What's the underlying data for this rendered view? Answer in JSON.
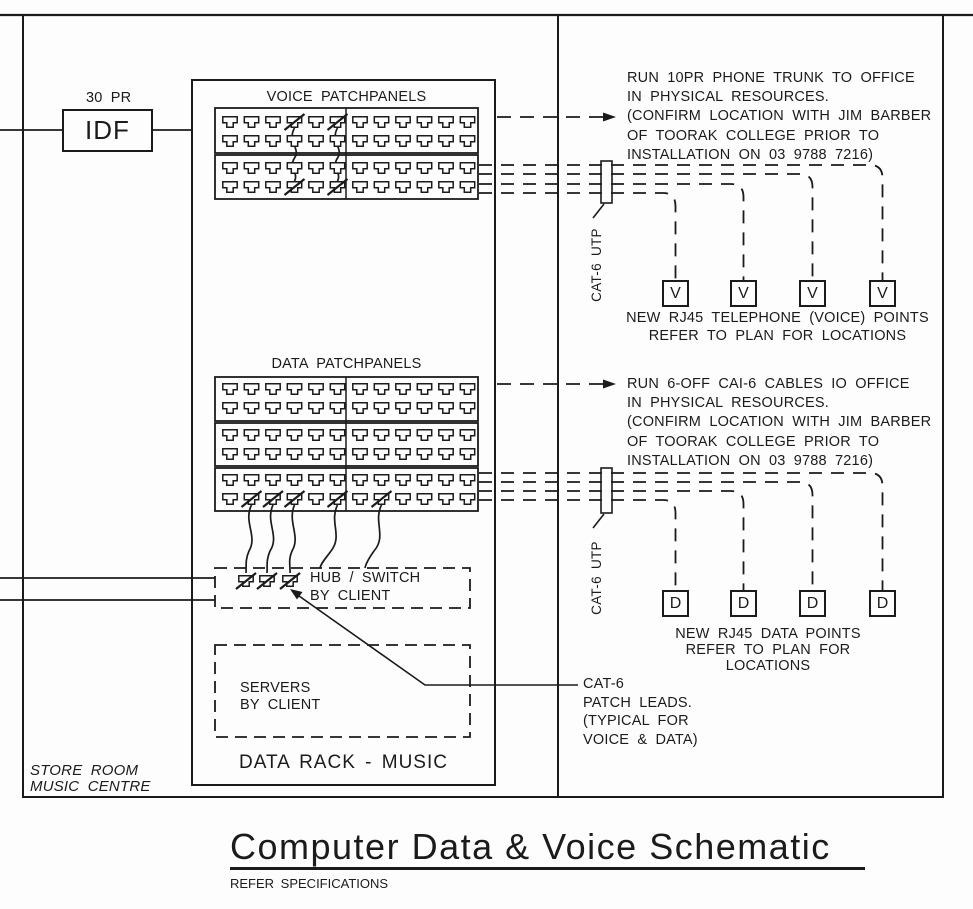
{
  "idf": {
    "label": "IDF",
    "cable": "30 PR"
  },
  "rack": {
    "title": "DATA RACK - MUSIC",
    "voice_title": "VOICE PATCHPANELS",
    "data_title": "DATA PATCHPANELS",
    "hub_line1": "HUB / SWITCH",
    "hub_line2": "BY CLIENT",
    "servers_line1": "SERVERS",
    "servers_line2": "BY CLIENT"
  },
  "room": {
    "line1": "STORE ROOM",
    "line2": "MUSIC CENTRE"
  },
  "voice_note": {
    "l1": "RUN 10PR PHONE TRUNK TO OFFICE",
    "l2": "IN PHYSICAL RESOURCES.",
    "l3": "(CONFIRM LOCATION WITH JIM BARBER",
    "l4": "OF TOORAK COLLEGE PRIOR TO",
    "l5": "INSTALLATION ON 03 9788 7216)"
  },
  "data_note": {
    "l1": "RUN 6-OFF CAI-6 CABLES IO OFFICE",
    "l2": "IN PHYSICAL RESOURCES.",
    "l3": "(CONFIRM LOCATION WITH JIM BARBER",
    "l4": "OF TOORAK COLLEGE PRIOR TO",
    "l5": "INSTALLATION ON 03 9788 7216)"
  },
  "voice_points": {
    "symbol": "V",
    "cap1": "NEW RJ45 TELEPHONE (VOICE) POINTS",
    "cap2": "REFER TO PLAN FOR LOCATIONS"
  },
  "data_points": {
    "symbol": "D",
    "cap1": "NEW RJ45 DATA POINTS",
    "cap2": "REFER TO PLAN FOR",
    "cap3": "LOCATIONS"
  },
  "cables": {
    "voice_utp": "CAT-6 UTP",
    "data_utp": "CAT-6 UTP"
  },
  "patch_note": {
    "l1": "CAT-6",
    "l2": "PATCH LEADS.",
    "l3": "(TYPICAL FOR",
    "l4": "VOICE & DATA)"
  },
  "title_block": {
    "title": "Computer Data & Voice Schematic",
    "subtitle": "REFER SPECIFICATIONS"
  },
  "ink_color": "#1b1b1b"
}
